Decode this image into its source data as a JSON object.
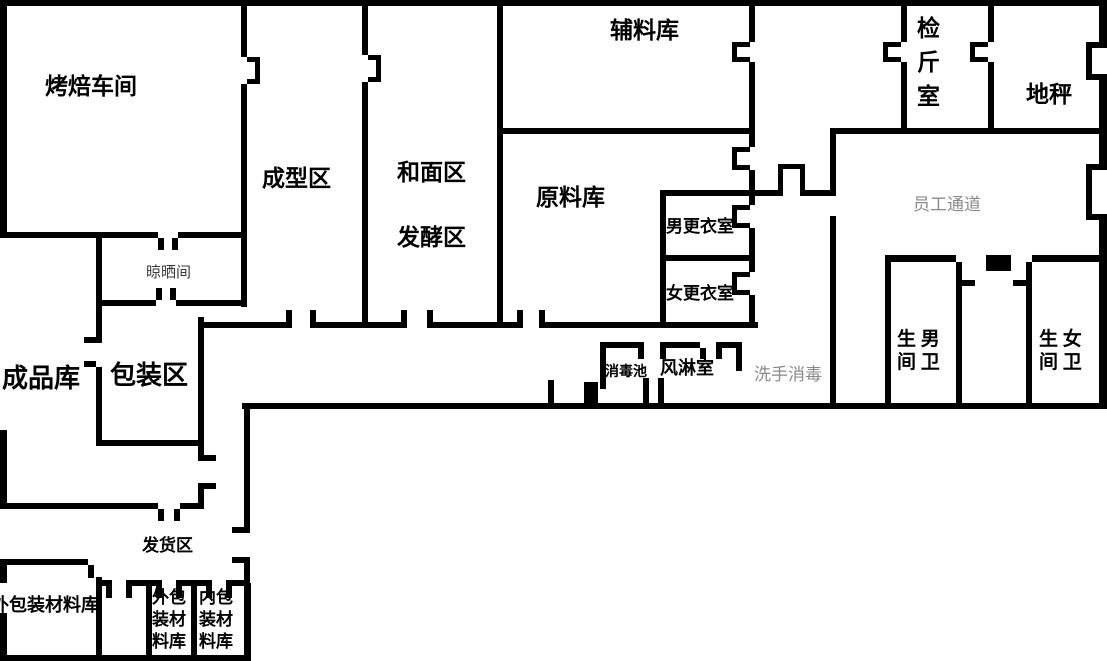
{
  "page": {
    "background": "#ffffff",
    "wall_color": "#000000",
    "muted_label_color": "#8a8a8a"
  },
  "floorplan": {
    "rooms": {
      "baking_workshop": {
        "label": "烤焙车间"
      },
      "forming_area": {
        "label": "成型区"
      },
      "dough_mixing_area": {
        "label": "和面区"
      },
      "fermentation_area": {
        "label": "发酵区"
      },
      "auxiliary_material_warehouse": {
        "label": "辅料库"
      },
      "raw_material_warehouse": {
        "label": "原料库"
      },
      "weighing_room": {
        "label": "检\n斤\n室"
      },
      "floor_scale": {
        "label": "地秤"
      },
      "staff_corridor": {
        "label": "员工通道"
      },
      "drying_room": {
        "label": "晾晒间"
      },
      "men_changing_room": {
        "label": "男更衣室"
      },
      "women_changing_room": {
        "label": "女更衣室"
      },
      "finished_goods_warehouse": {
        "label": "成品库"
      },
      "packaging_area": {
        "label": "包装区"
      },
      "hand_wash_disinfection": {
        "label": "洗手消毒"
      },
      "disinfection_pool": {
        "label": "消毒池"
      },
      "air_shower_room": {
        "label": "风淋室"
      },
      "men_toilet": {
        "label": "生 男\n间 卫"
      },
      "women_toilet": {
        "label": "生 女\n间 卫"
      },
      "shipping_area": {
        "label": "发货区"
      },
      "outer_packaging_material_warehouse_large": {
        "label": "外包装材料库"
      },
      "outer_packaging_material_warehouse": {
        "label": "外包\n装材\n料库"
      },
      "inner_packaging_material_warehouse": {
        "label": "内包\n装材\n料库"
      }
    }
  }
}
